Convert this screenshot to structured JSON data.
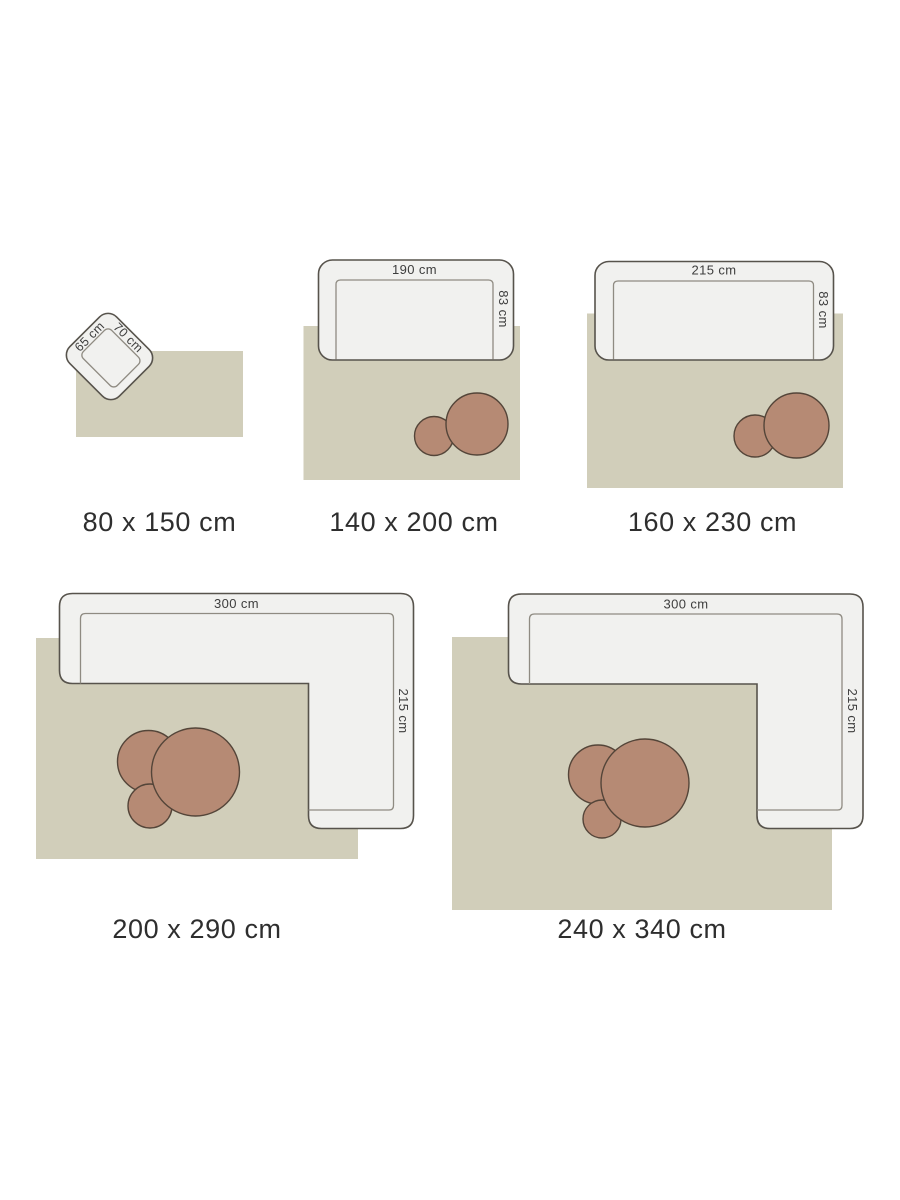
{
  "title": "Rug size guide",
  "colors": {
    "bg": "#ffffff",
    "rug": "#d1ceba",
    "furniture-fill": "#f1f1ef",
    "furniture-outline": "#57534c",
    "seat-line": "#8f8b82",
    "pouf-fill": "#b68a74",
    "pouf-outline": "#544539",
    "label-text": "#2e2e2e",
    "dim-text": "#3d3d3d"
  },
  "diagrams": [
    {
      "furniture": "armchair",
      "size_label": "80 x 150 cm",
      "width_label": "65 cm",
      "depth_label": "70 cm",
      "poufs": 0
    },
    {
      "furniture": "sofa",
      "size_label": "140 x 200 cm",
      "width_label": "190 cm",
      "depth_label": "83 cm",
      "poufs": 2
    },
    {
      "furniture": "sofa",
      "size_label": "160 x 230 cm",
      "width_label": "215 cm",
      "depth_label": "83 cm",
      "poufs": 2
    },
    {
      "furniture": "corner-sofa",
      "size_label": "200 x 290 cm",
      "width_label": "300 cm",
      "depth_label": "215 cm",
      "poufs": 3
    },
    {
      "furniture": "corner-sofa",
      "size_label": "240 x 340 cm",
      "width_label": "300 cm",
      "depth_label": "215 cm",
      "poufs": 3
    }
  ]
}
